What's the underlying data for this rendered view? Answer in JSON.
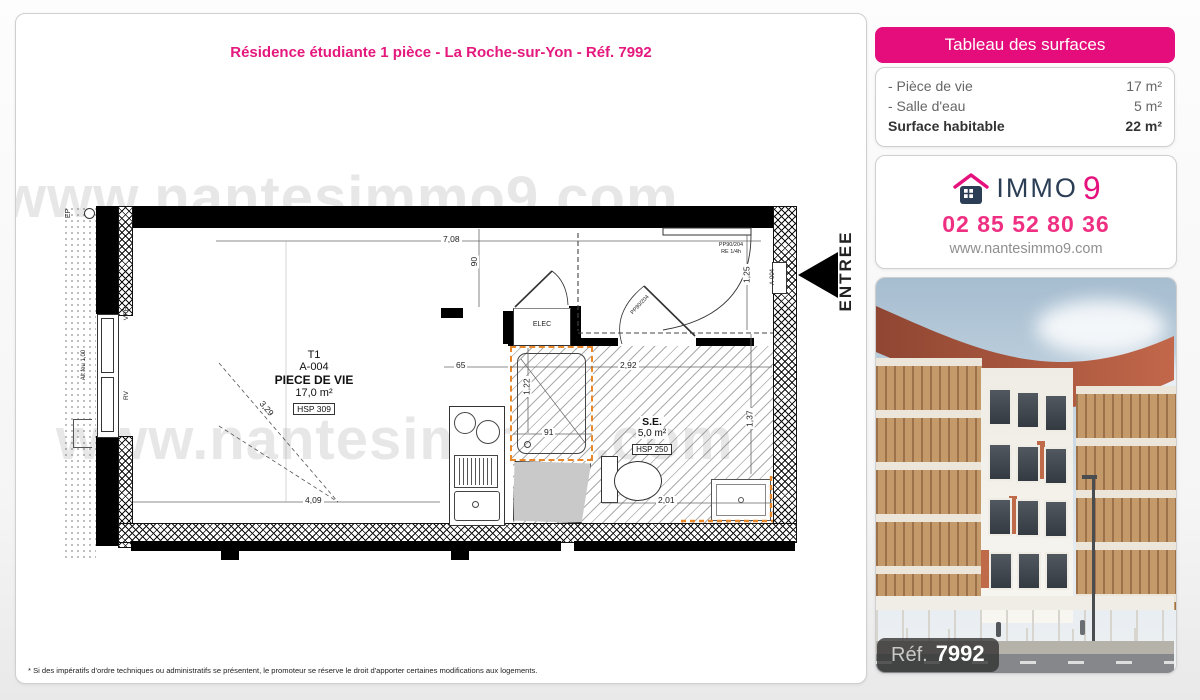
{
  "page": {
    "title": "Résidence étudiante 1 pièce - La Roche-sur-Yon - Réf. 7992",
    "disclaimer": "* Si des impératifs d'ordre techniques ou administratifs se présentent, le promoteur se réserve le droit d'apporter certaines modifications aux logements.",
    "watermark": "www.nantesimmo9.com"
  },
  "surfaces": {
    "header": "Tableau des surfaces",
    "rows": [
      {
        "label": "- Pièce de vie",
        "value": "17 m²"
      },
      {
        "label": "- Salle d'eau",
        "value": "5 m²"
      }
    ],
    "total": {
      "label": "Surface habitable",
      "value": "22 m²"
    }
  },
  "agency": {
    "brand_text": "IMMO",
    "brand_digit": "9",
    "phone": "02 85 52 80 36",
    "website": "www.nantesimmo9.com"
  },
  "photo": {
    "ref_label": "Réf.",
    "ref_number": "7992"
  },
  "plan": {
    "living": {
      "type": "T1",
      "lot": "A-004",
      "name": "PIECE DE VIE",
      "area": "17,0 m²",
      "hsp": "HSP 309"
    },
    "bathroom": {
      "name": "S.E.",
      "area": "5,0 m²",
      "hsp": "HSP 250"
    },
    "labels": {
      "elec": "ELEC",
      "entree": "ENTREE",
      "ep": "EP",
      "vre": "VRE",
      "rv": "RV",
      "alt_feu": "Alt feu 1,00",
      "entry_door_ref": "PP90/204",
      "entry_door_fire": "RE 1/4h",
      "bath_door_ref": "PP80/204",
      "lot_tag": "A-004"
    },
    "dims": {
      "width_total": "7,08",
      "entry_depth": "90",
      "window_height": "3,29",
      "kitchen_gap": "65",
      "bath_width": "2,92",
      "shower_depth": "1,22",
      "shower_width": "91",
      "entry_width": "1,25",
      "bath_depth": "1,37",
      "bath_length": "2,01",
      "living_width": "4,09"
    }
  },
  "colors": {
    "accent_pink": "#e5127d",
    "brand_navy": "#2c3e55",
    "plan_highlight_orange": "#e8882a"
  }
}
